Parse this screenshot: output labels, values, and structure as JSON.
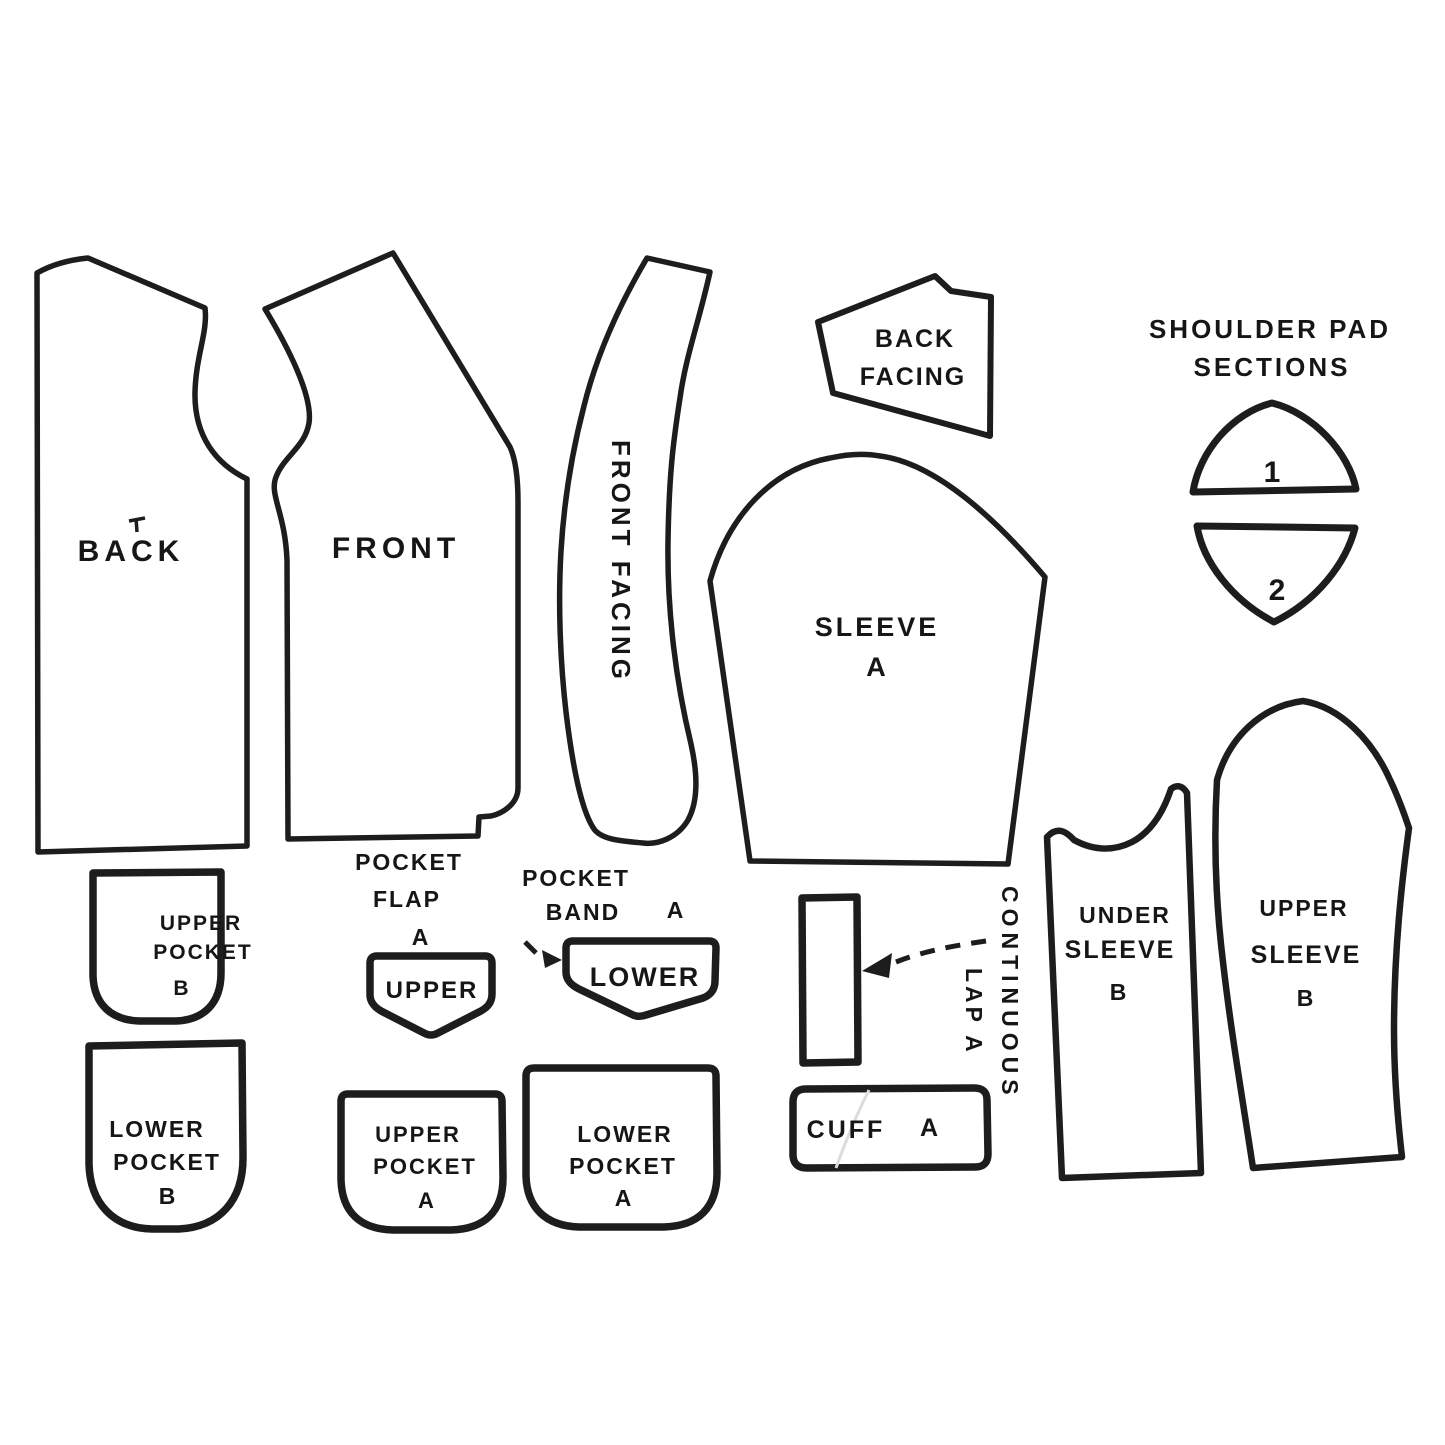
{
  "figure": {
    "kind": "sewing pattern pieces cutting diagram",
    "ink_color": "#1d1d1d",
    "background_color": "#ffffff"
  },
  "pieces": {
    "back": {
      "label": "BACK"
    },
    "front": {
      "label": "FRONT"
    },
    "front_facing": {
      "label": "FRONT FACING"
    },
    "back_facing": {
      "line1": "BACK",
      "line2": "FACING"
    },
    "sleeve_a": {
      "line1": "SLEEVE",
      "line2": "A"
    },
    "shoulder_pad_sections": {
      "title_line1": "SHOULDER PAD",
      "title_line2": "SECTIONS",
      "section1": "1",
      "section2": "2"
    },
    "upper_pocket_b": {
      "line1": "UPPER",
      "line2": "POCKET",
      "line3": "B"
    },
    "lower_pocket_b": {
      "line1": "LOWER",
      "line2": "POCKET",
      "line3": "B"
    },
    "pocket_flap_a": {
      "caption_line1": "POCKET",
      "caption_line2": "FLAP",
      "caption_line3": "A",
      "flap_label": "UPPER"
    },
    "pocket_band_a": {
      "caption_line1": "POCKET",
      "caption_word": "BAND",
      "caption_letter": "A",
      "flap_label": "LOWER"
    },
    "upper_pocket_a": {
      "line1": "UPPER",
      "line2": "POCKET",
      "line3": "A"
    },
    "lower_pocket_a": {
      "line1": "LOWER",
      "line2": "POCKET",
      "line3": "A"
    },
    "cuff_a": {
      "word": "CUFF",
      "letter": "A"
    },
    "continuous_lap_a": {
      "line1": "CONTINUOUS",
      "line2": "LAP A"
    },
    "under_sleeve_b": {
      "line1": "UNDER",
      "line2": "SLEEVE",
      "line3": "B"
    },
    "upper_sleeve_b": {
      "line1": "UPPER",
      "line2": "SLEEVE",
      "line3": "B"
    }
  }
}
